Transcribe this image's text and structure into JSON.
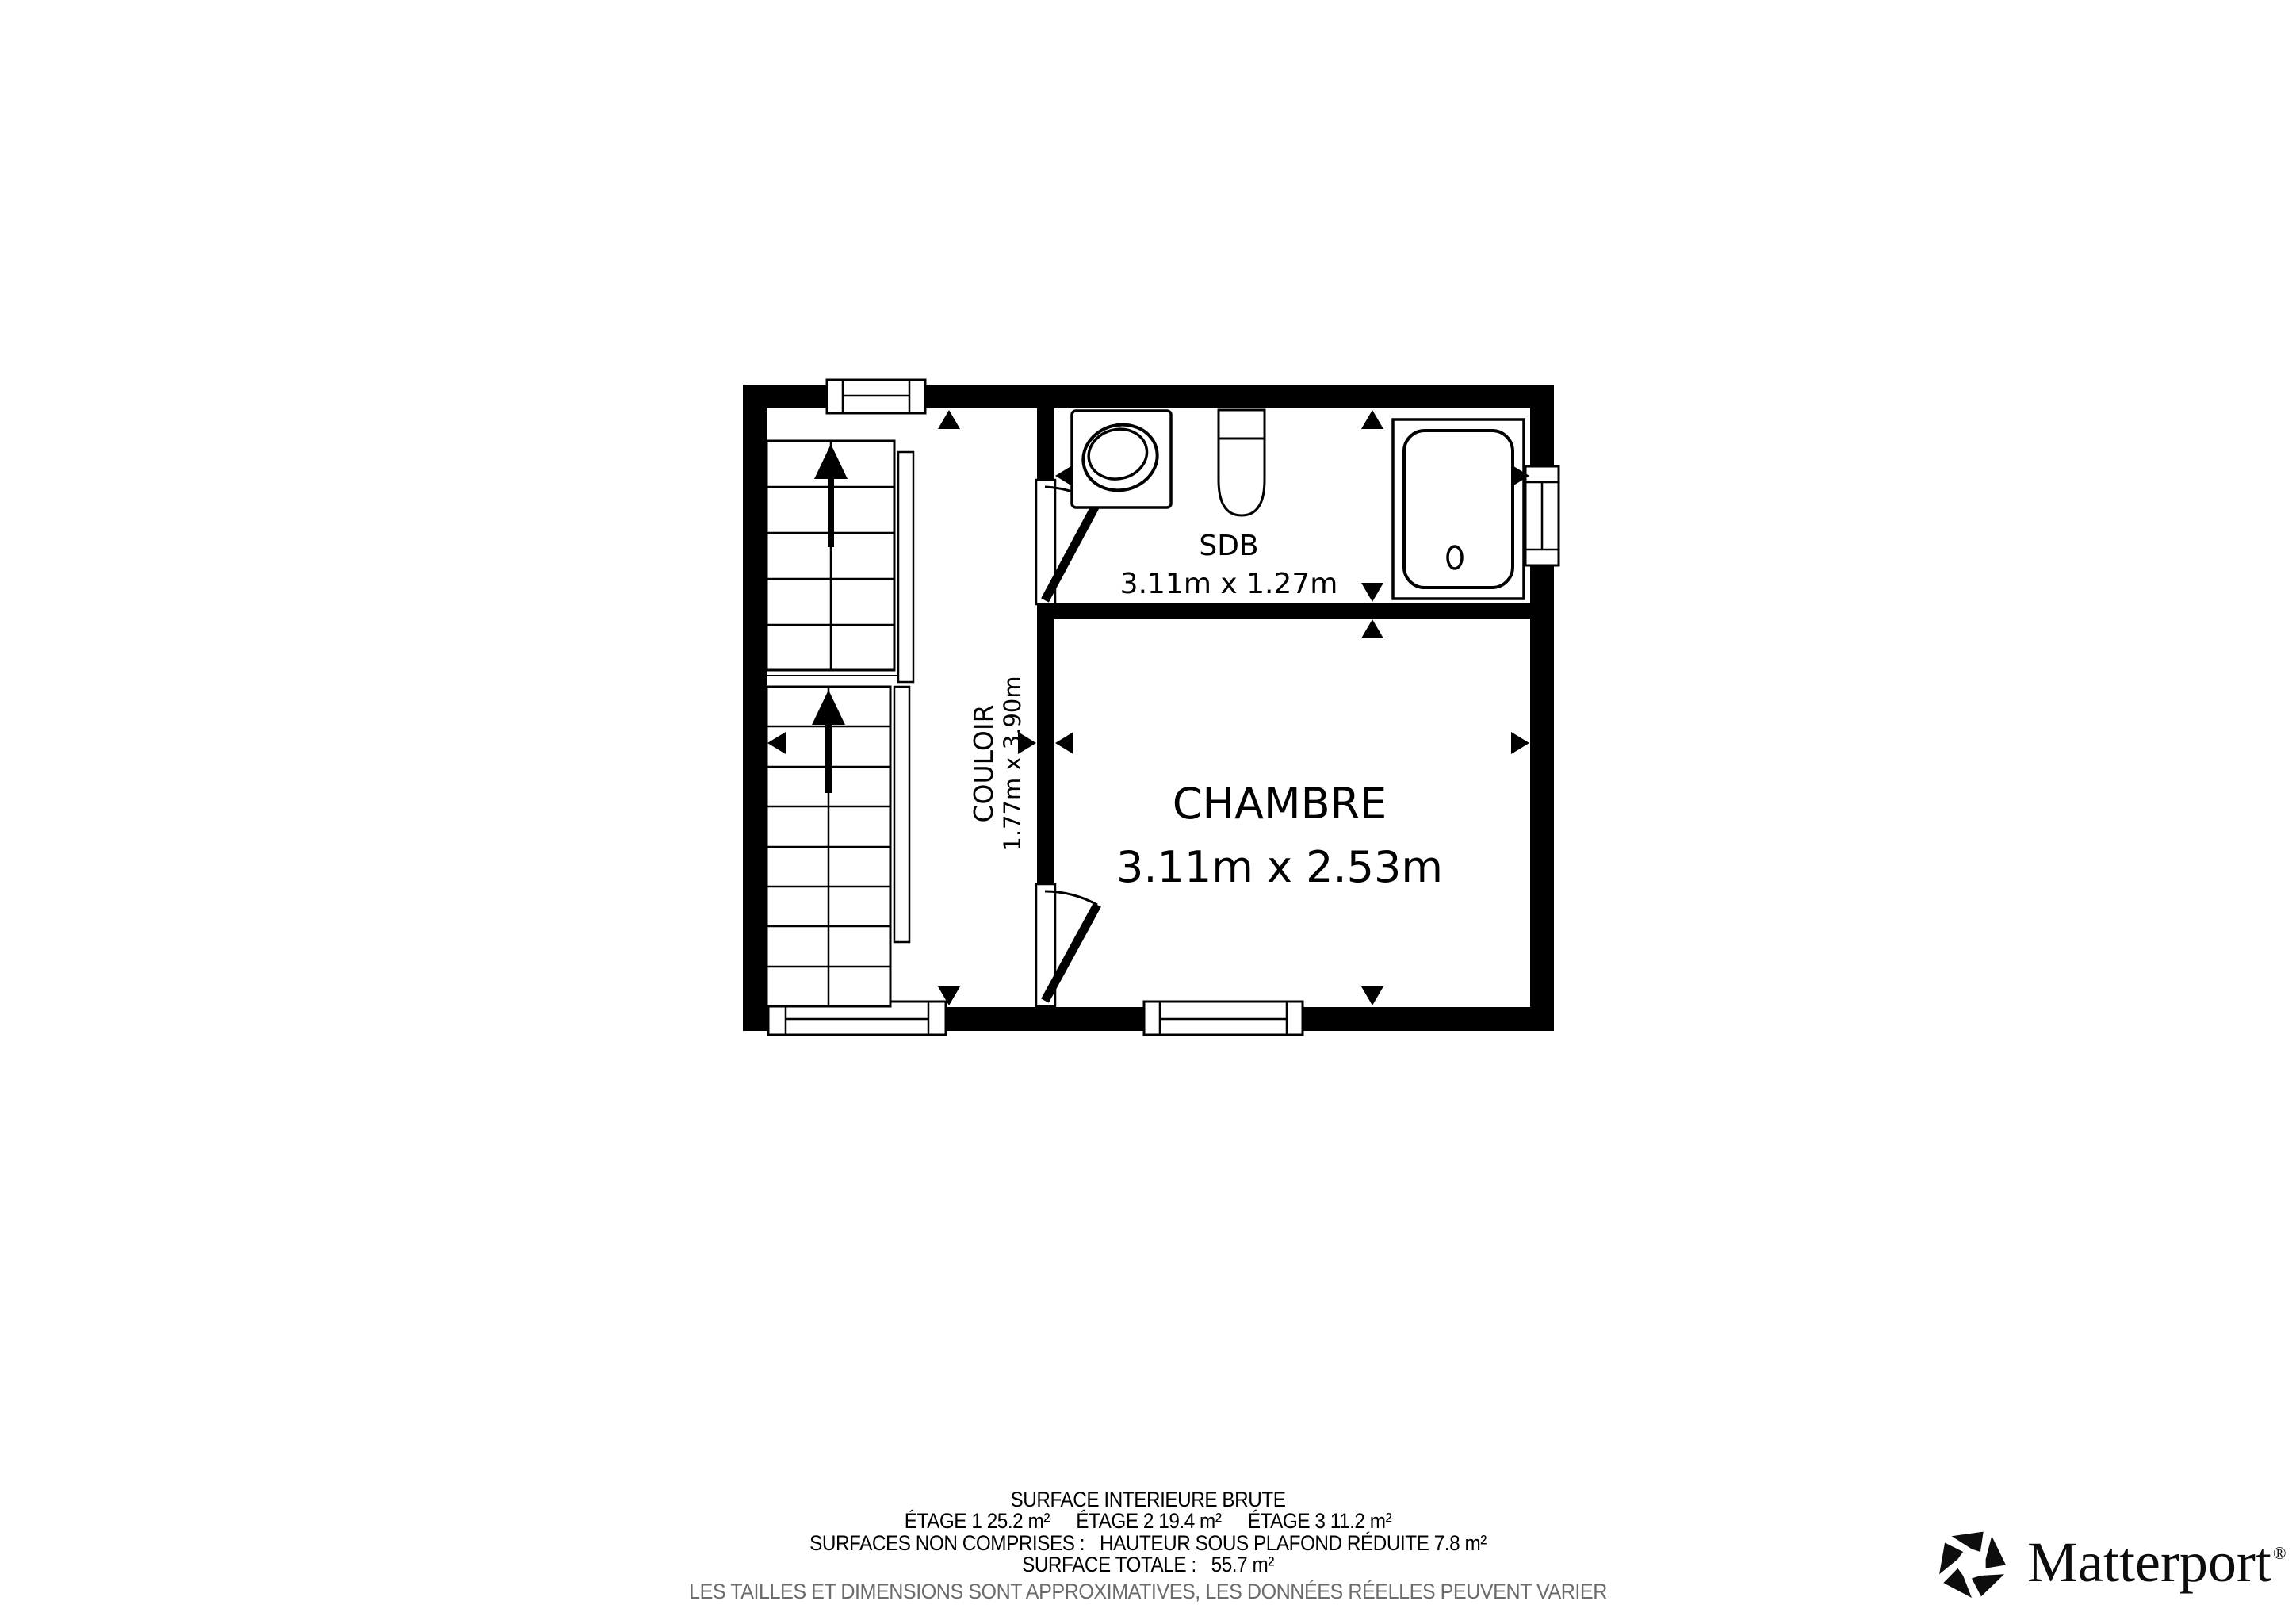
{
  "floor_plan": {
    "rooms": [
      {
        "id": "sdb",
        "name": "SDB",
        "dimensions": "3.11m x 1.27m"
      },
      {
        "id": "chambre",
        "name": "CHAMBRE",
        "dimensions": "3.11m x 2.53m"
      },
      {
        "id": "couloir",
        "name": "COULOIR",
        "dimensions": "1.77m x 3.90m"
      }
    ],
    "fixtures": [
      "sink",
      "toilet",
      "bathtub",
      "staircase"
    ],
    "icon_names": [
      "stair-up-arrow-icon",
      "measure-arrow-icon",
      "door-swing-icon",
      "window-icon"
    ]
  },
  "surface_summary": {
    "title": "SURFACE INTERIEURE BRUTE",
    "etages": [
      {
        "text": "ÉTAGE 1 25.2 m²"
      },
      {
        "text": "ÉTAGE 2 19.4 m²"
      },
      {
        "text": "ÉTAGE 3 11.2 m²"
      }
    ],
    "non_comprises_label": "SURFACES NON COMPRISES :",
    "non_comprises_value": "HAUTEUR SOUS PLAFOND RÉDUITE 7.8 m²",
    "total_label": "SURFACE TOTALE :",
    "total_value": "55.7 m²",
    "disclaimer": "LES TAILLES ET DIMENSIONS SONT APPROXIMATIVES, LES DONNÉES RÉELLES PEUVENT VARIER"
  },
  "branding": {
    "wordmark": "Matterport",
    "registered_mark": "®"
  },
  "colors": {
    "walls": "#000000",
    "background": "#ffffff",
    "disclaimer_text": "#6b6b6b"
  }
}
